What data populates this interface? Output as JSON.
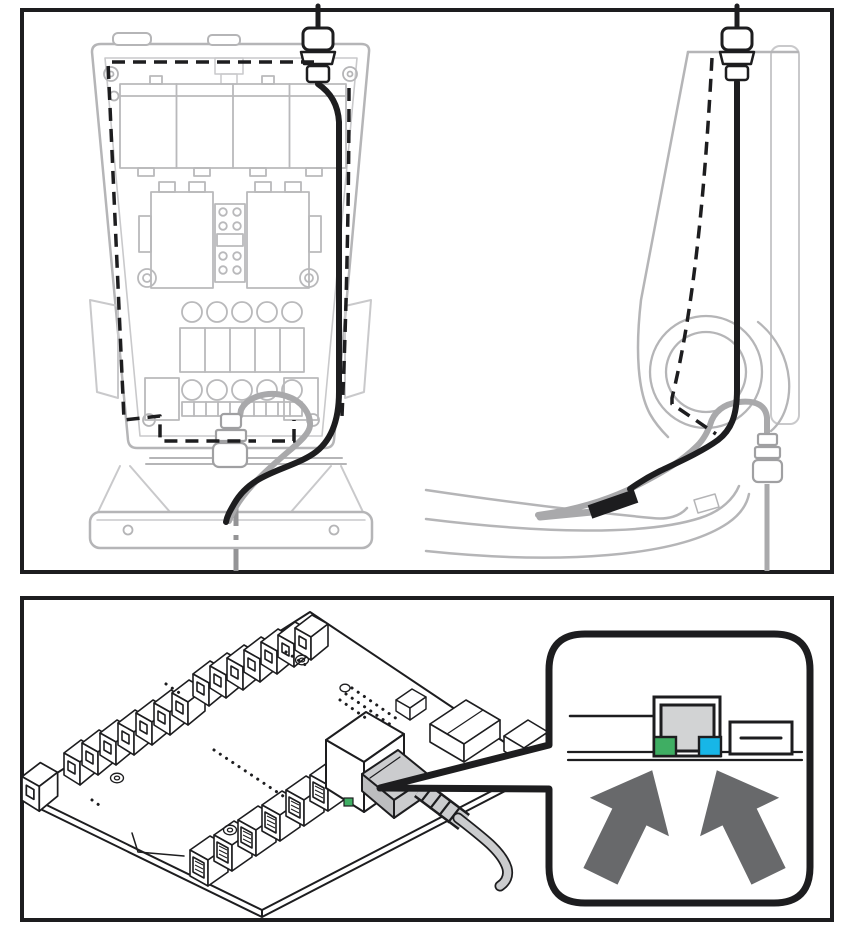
{
  "figure": {
    "colors": {
      "ink": "#1d1d1f",
      "enclosure_gray": "#b5b5b7",
      "enclosure_gray_light": "#c9c9cb",
      "component_gray": "#b9b9bb",
      "cable_gray": "#a9a9ab",
      "centerline_gray": "#949496",
      "plug_gray": "#cbccce",
      "background": "#ffffff"
    },
    "routing_panel": {
      "front_view": "front-view-open-enclosure-cable-routing",
      "side_view": "side-view-enclosure-cable-routing"
    },
    "board_panel": {
      "board": "controller-pcb-with-ethernet-cable",
      "callout": {
        "port": "rj45-port-front-view",
        "port_fill": "#d2d3d4",
        "led_green": "#3fae63",
        "led_blue": "#17b6e7",
        "arrow_color": "#68696b"
      }
    }
  }
}
